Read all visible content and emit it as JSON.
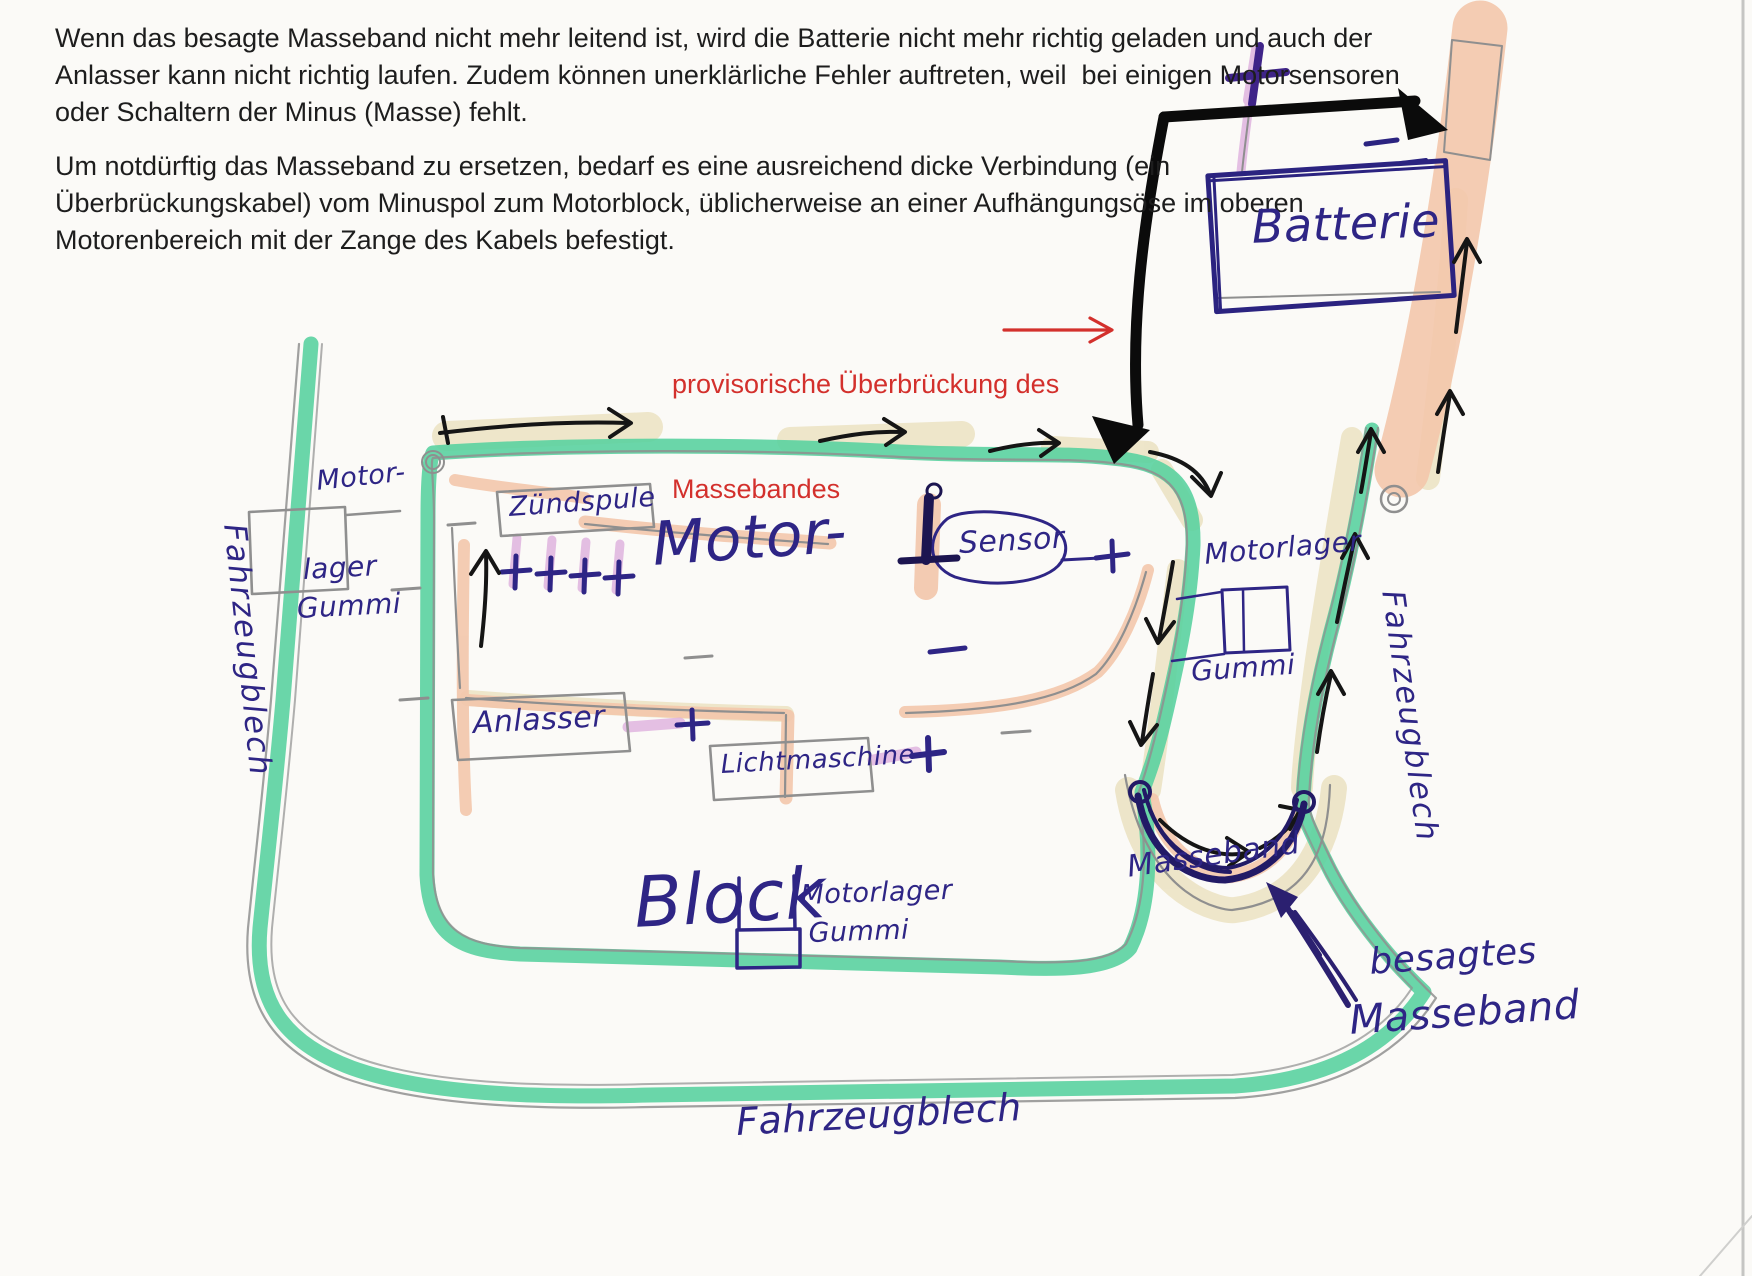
{
  "intro": {
    "p1": [
      "Wenn das besagte Masseband nicht mehr leitend ist, wird die Batterie nicht mehr richtig geladen und auch der",
      "Anlasser kann nicht richtig laufen. Zudem können unerklärliche Fehler auftreten, weil  bei einigen Motorsensoren",
      "oder Schaltern der Minus (Masse) fehlt."
    ],
    "p2": [
      "Um notdürftig das Masseband zu ersetzen, bedarf es eine ausreichend dicke Verbindung (ein",
      "Überbrückungskabel) vom Minuspol zum Motorblock, üblicherweise an einer Aufhängungsöse im oberen",
      "Motorenbereich mit der Zange des Kabels befestigt."
    ]
  },
  "red_note": {
    "line1": "provisorische Überbrückung des",
    "line2": "Massebandes",
    "color": "#d3302c"
  },
  "diagram": {
    "battery_label": "Batterie",
    "battery_plus": "+",
    "battery_minus": "−",
    "motor_label": "Motor-",
    "block_label": "Block",
    "zuendspule_label": "Zündspule",
    "zuendspule_plus_row": "++++",
    "sensor_label": "Sensor",
    "sensor_plus": "+",
    "anlasser_label": "Anlasser",
    "anlasser_plus": "+",
    "lichtmaschine_label": "Lichtmaschine",
    "lichtmaschine_plus": "+",
    "mount_left": {
      "line1": "Motor-",
      "line2": "lager",
      "line3": "Gummi"
    },
    "mount_right": {
      "line1": "Motorlager",
      "line2": "Gummi"
    },
    "mount_bottom": {
      "line1": "Motorlager",
      "line2": "Gummi"
    },
    "masseband_label": "Masseband",
    "besagtes": {
      "line1": "besagtes",
      "line2": "Masseband"
    },
    "fahrzeugblech_left": "Fahrzeugblech",
    "fahrzeugblech_bottom": "Fahrzeugblech",
    "fahrzeugblech_right": "Fahrzeugblech",
    "colors": {
      "marker_green": "#5ad2a0",
      "highlight_tan": "#ebe2c2",
      "highlight_peach": "#f3c6ab",
      "highlight_pink": "#dcabdc",
      "ink_blue": "#2e2585",
      "strap_navy": "#221a66",
      "pencil_gray": "#8f8f8f",
      "cable_black": "#0b0b0b",
      "note_red": "#d3302c"
    }
  }
}
